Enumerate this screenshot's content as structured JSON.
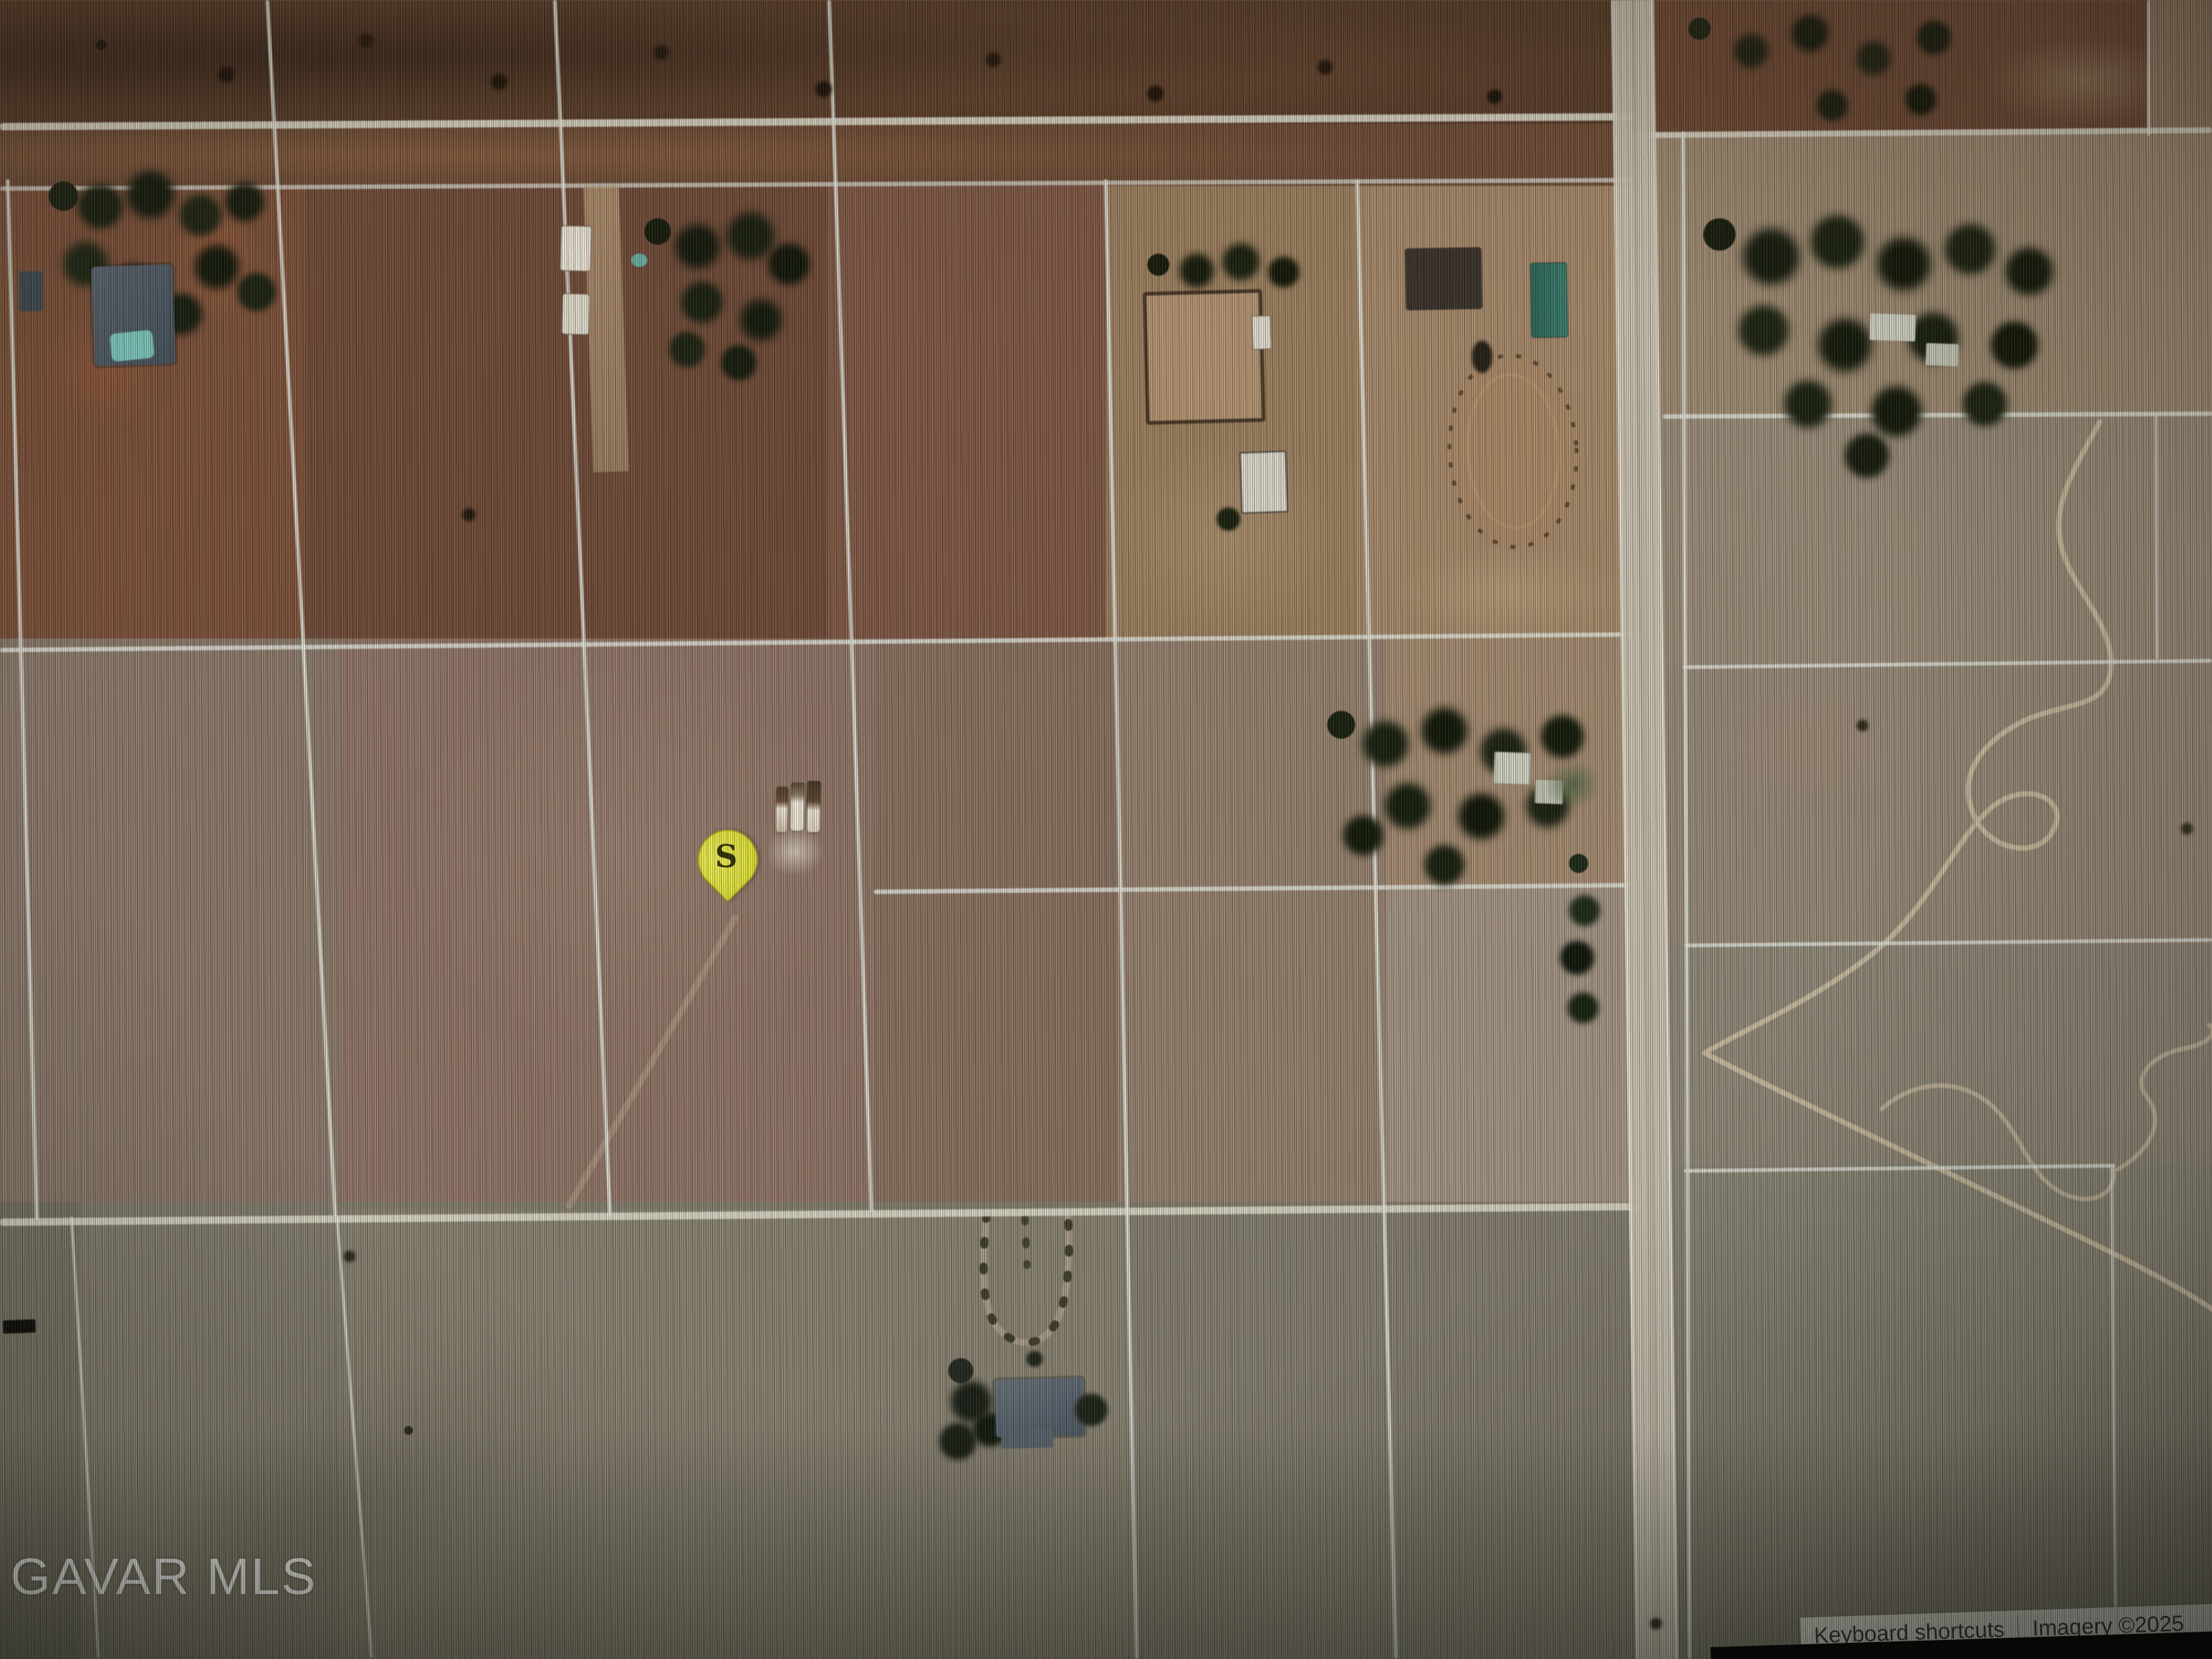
{
  "map": {
    "marker": {
      "label": "S"
    },
    "watermark": "GAVAR MLS",
    "attribution": {
      "keyboard_shortcuts": "Keyboard shortcuts",
      "imagery_credit": "Imagery ©2025"
    }
  },
  "colors": {
    "pin_fill": "#dcdf31",
    "pin_border": "#a8ab1e",
    "pin_label": "#2f3108",
    "attribution_bg": "#d8d5cc",
    "attribution_text": "#2e2e2c",
    "watermark": "#f7f7f5",
    "road": "#d9d6c5",
    "parcel_line": "#e3e6de",
    "highway": "#c9c2b1",
    "arena_fence": "#54402c",
    "trail": "#d2c3a6"
  }
}
